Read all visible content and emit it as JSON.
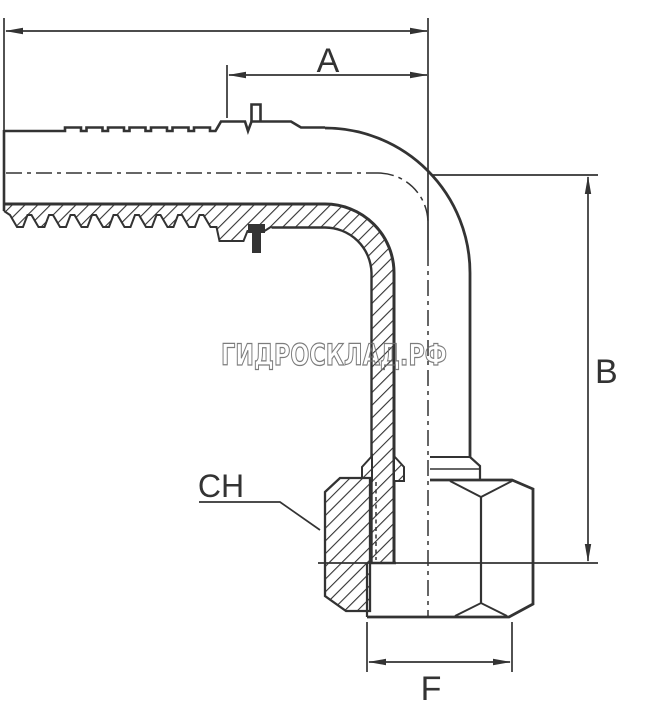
{
  "watermark": {
    "text": "ГИДРОСКЛАД.РФ"
  },
  "dimensions": {
    "a": {
      "label": "A"
    },
    "b": {
      "label": "B"
    },
    "ch": {
      "label": "CH"
    },
    "f": {
      "label": "F"
    }
  },
  "colors": {
    "line": "#333333",
    "watermark_outline": "#6e6e6e",
    "background": "#ffffff"
  }
}
